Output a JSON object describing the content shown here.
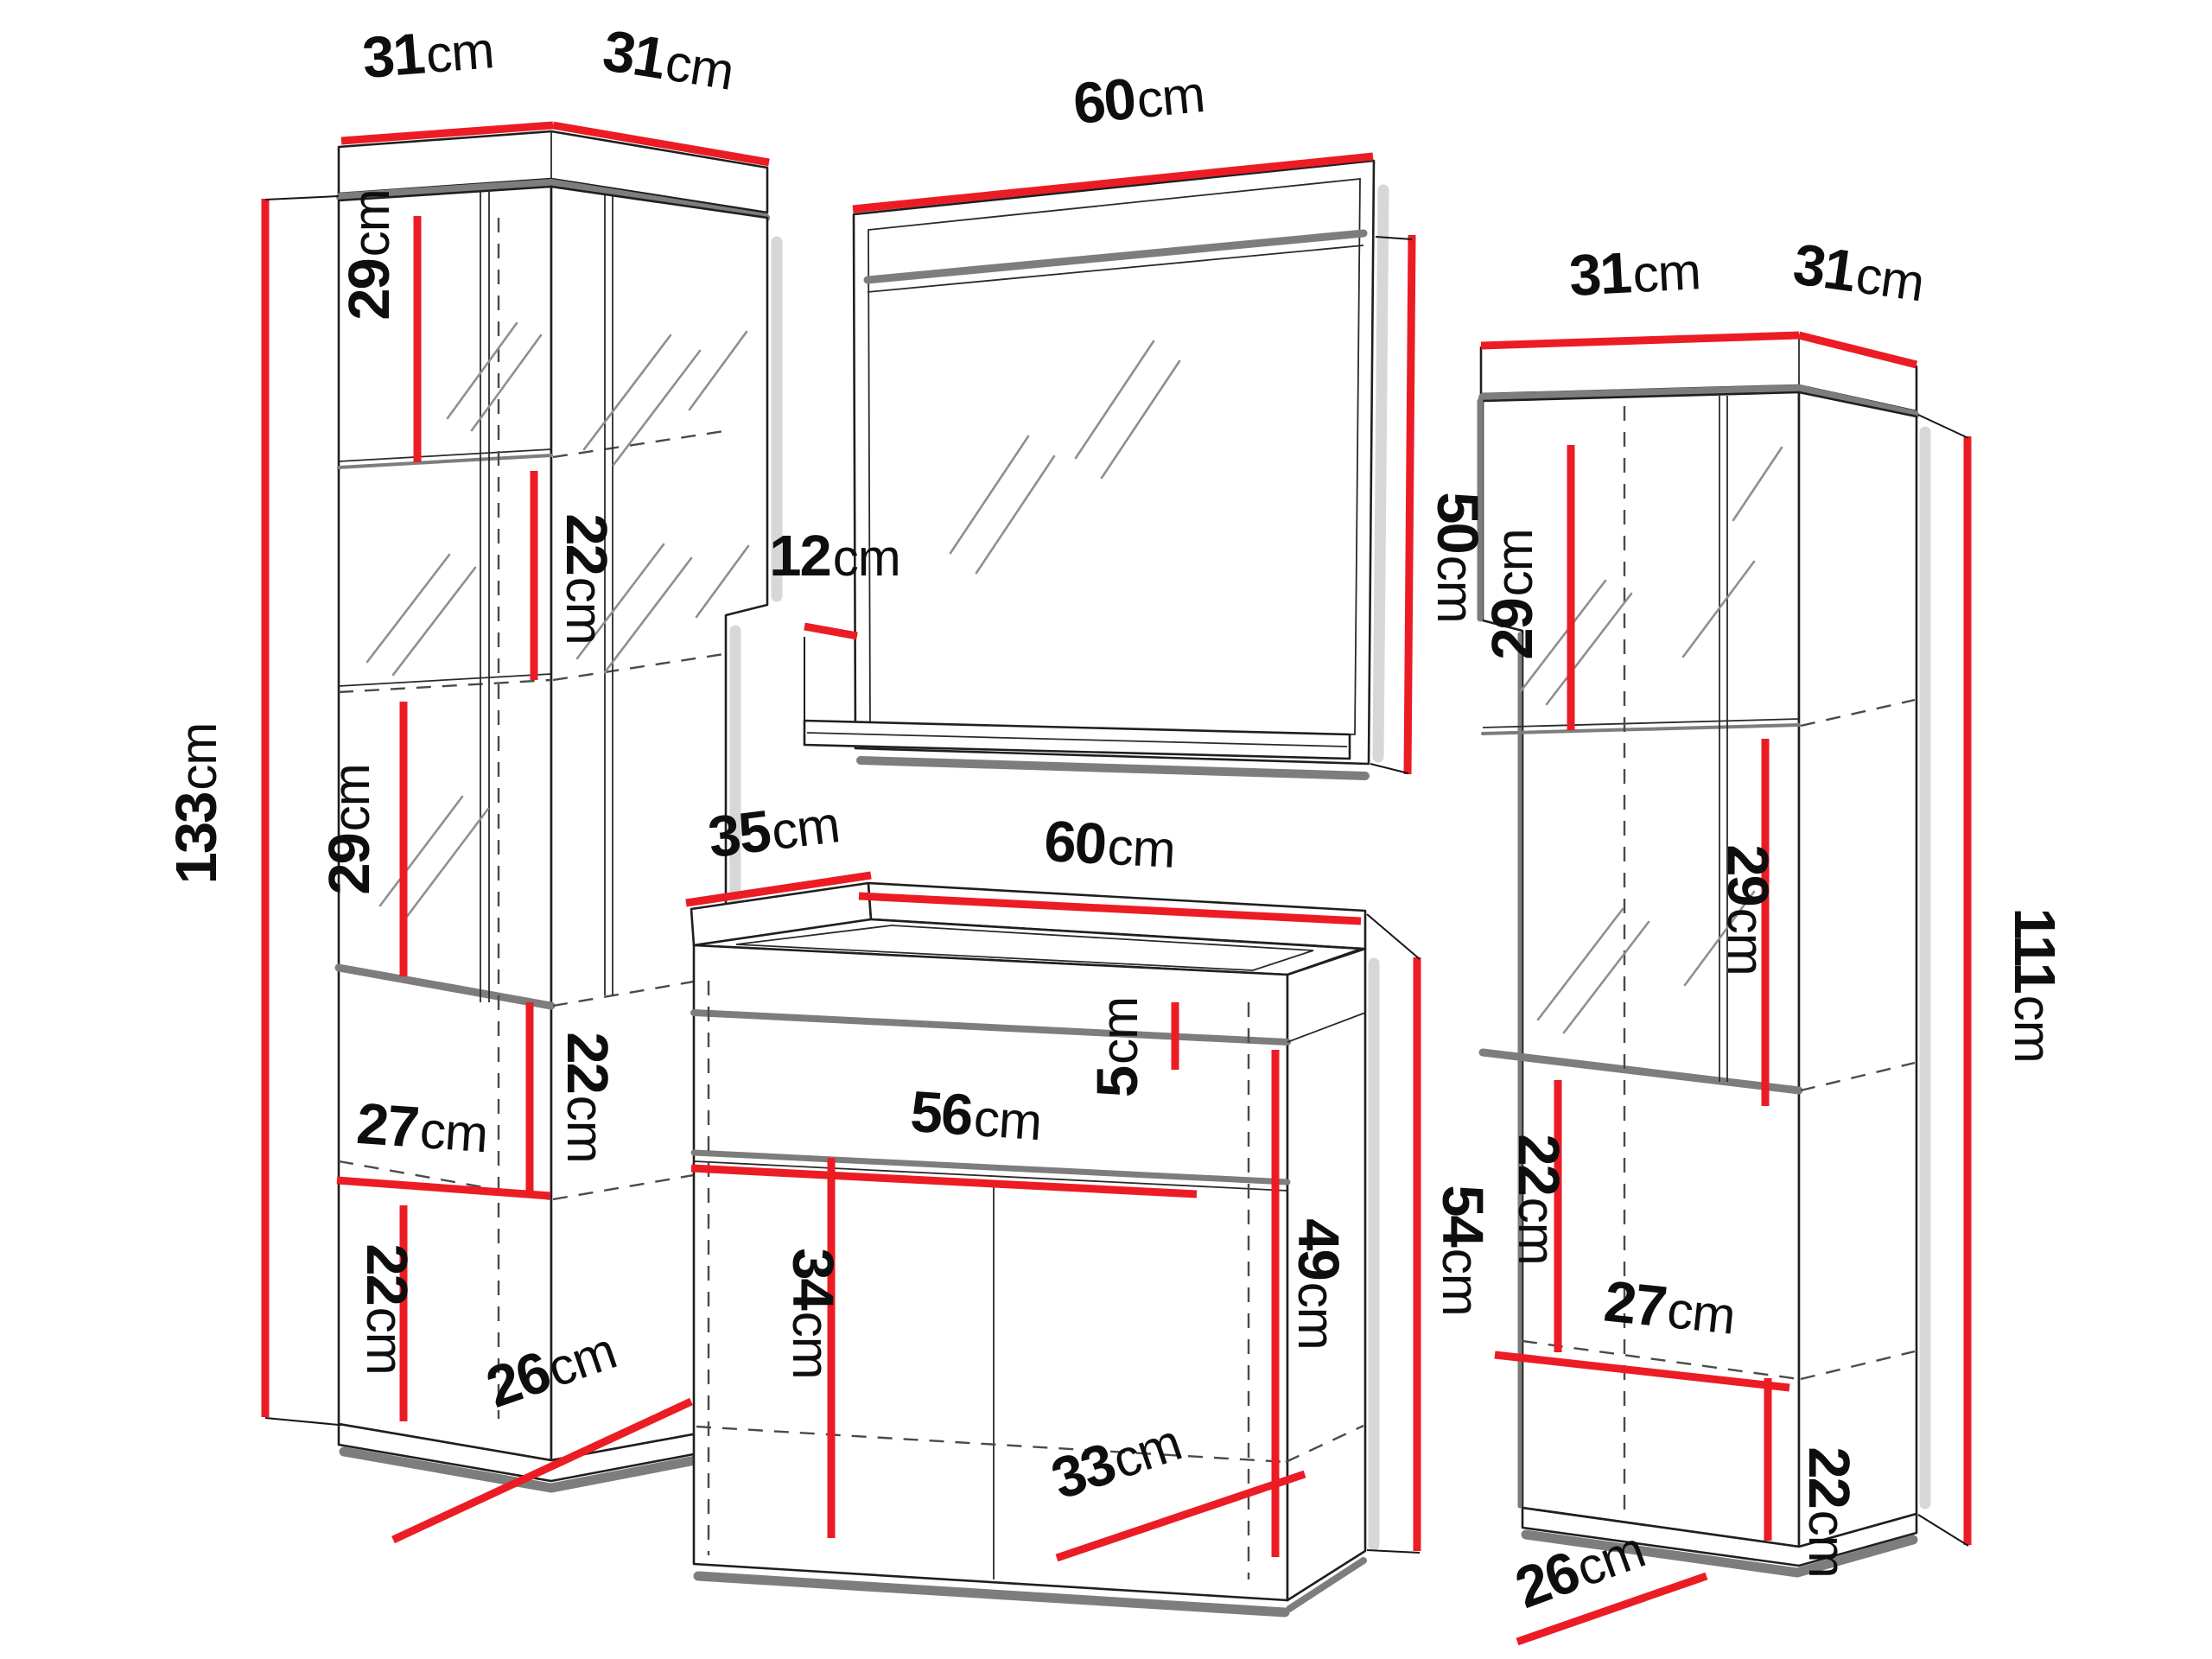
{
  "diagram": {
    "type": "furniture-dimension-drawing",
    "accent_color": "#ec1c24",
    "outline_color": "#1f1f1f",
    "pieces": {
      "left_cabinet": {
        "name": "tall display cabinet (left)",
        "dims": {
          "top_front_edge": {
            "v": "31",
            "u": "cm"
          },
          "top_side_edge": {
            "v": "31",
            "u": "cm"
          },
          "total_height": {
            "v": "133",
            "u": "cm"
          },
          "top_shelf_height": {
            "v": "29",
            "u": "cm"
          },
          "glass_shelf_height": {
            "v": "22",
            "u": "cm"
          },
          "middle_shelf_height": {
            "v": "29",
            "u": "cm"
          },
          "open_shelf_height": {
            "v": "22",
            "u": "cm"
          },
          "inner_width": {
            "v": "27",
            "u": "cm"
          },
          "bottom_shelf_height": {
            "v": "22",
            "u": "cm"
          },
          "base_depth": {
            "v": "26",
            "u": "cm"
          }
        }
      },
      "mirror": {
        "name": "wall mirror",
        "dims": {
          "width": {
            "v": "60",
            "u": "cm"
          },
          "height": {
            "v": "50",
            "u": "cm"
          },
          "ledge_depth": {
            "v": "12",
            "u": "cm"
          }
        }
      },
      "vanity": {
        "name": "washbasin cabinet",
        "dims": {
          "top_depth": {
            "v": "35",
            "u": "cm"
          },
          "top_width": {
            "v": "60",
            "u": "cm"
          },
          "worktop_height": {
            "v": "5",
            "u": "cm"
          },
          "inner_width": {
            "v": "56",
            "u": "cm"
          },
          "door_inner_height": {
            "v": "34",
            "u": "cm"
          },
          "side_height": {
            "v": "49",
            "u": "cm"
          },
          "total_height": {
            "v": "54",
            "u": "cm"
          },
          "inner_depth": {
            "v": "33",
            "u": "cm"
          }
        }
      },
      "right_cabinet": {
        "name": "tall display cabinet (right)",
        "dims": {
          "top_side_edge": {
            "v": "31",
            "u": "cm"
          },
          "top_front_edge": {
            "v": "31",
            "u": "cm"
          },
          "top_shelf_height": {
            "v": "29",
            "u": "cm"
          },
          "middle_shelf_height": {
            "v": "29",
            "u": "cm"
          },
          "open_shelf_height": {
            "v": "22",
            "u": "cm"
          },
          "inner_width": {
            "v": "27",
            "u": "cm"
          },
          "bottom_shelf_height": {
            "v": "22",
            "u": "cm"
          },
          "base_depth": {
            "v": "26",
            "u": "cm"
          },
          "total_height": {
            "v": "111",
            "u": "cm"
          }
        }
      }
    }
  }
}
